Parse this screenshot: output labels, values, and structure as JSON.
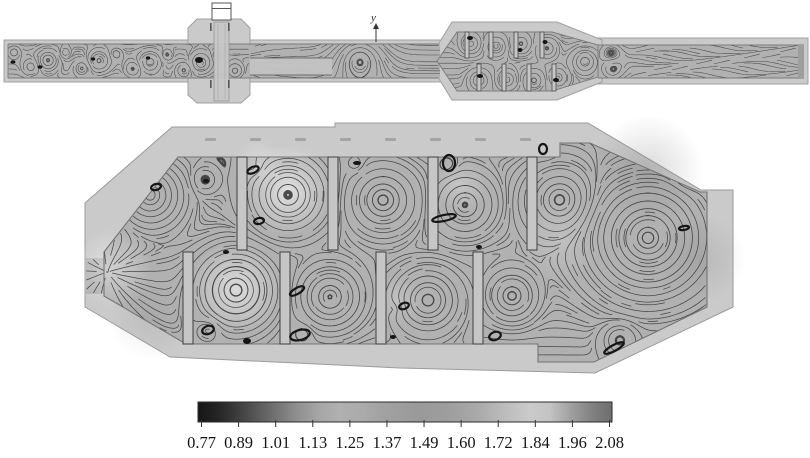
{
  "figure": {
    "axis_marker": {
      "label": "y"
    },
    "views": {
      "overview": {
        "name": "muffler-assembly-longitudinal-section"
      },
      "detail": {
        "name": "muffler-chamber-enlarged-section"
      }
    },
    "colorbar": {
      "orientation": "horizontal",
      "style": "grayscale",
      "tick_labels": [
        "0.77",
        "0.89",
        "1.01",
        "1.13",
        "1.25",
        "1.37",
        "1.49",
        "1.60",
        "1.72",
        "1.84",
        "1.96",
        "2.08"
      ],
      "gradient_stops": [
        [
          0,
          "#161616"
        ],
        [
          0.04,
          "#222222"
        ],
        [
          0.09,
          "#3a3a3a"
        ],
        [
          0.14,
          "#575757"
        ],
        [
          0.19,
          "#747474"
        ],
        [
          0.24,
          "#909090"
        ],
        [
          0.29,
          "#a5a5a5"
        ],
        [
          0.34,
          "#b0b0b0"
        ],
        [
          0.4,
          "#aaaaaa"
        ],
        [
          0.46,
          "#a0a0a0"
        ],
        [
          0.53,
          "#9a9a9a"
        ],
        [
          0.6,
          "#9d9d9d"
        ],
        [
          0.67,
          "#a8a8a8"
        ],
        [
          0.74,
          "#bcbcbc"
        ],
        [
          0.8,
          "#cacaca"
        ],
        [
          0.85,
          "#c4c4c4"
        ],
        [
          0.9,
          "#a0a0a0"
        ],
        [
          0.95,
          "#828282"
        ],
        [
          1,
          "#6e6e6e"
        ]
      ]
    },
    "colors": {
      "casing": "#cacaca",
      "interior_field": "#b1b1b1",
      "streamline": "#3a3a3a",
      "baffle_fill": "#c6c6c6",
      "page_background": "#ffffff",
      "colorbar_border": "#2b2b2b",
      "label_text": "#141414"
    }
  },
  "chart_data": {
    "type": "heatmap",
    "subtype": "streamline-contour-field",
    "title": "",
    "colorbar": {
      "min": 0.77,
      "max": 2.08,
      "tick_values": [
        0.77,
        0.89,
        1.01,
        1.13,
        1.25,
        1.37,
        1.49,
        1.6,
        1.72,
        1.84,
        1.96,
        2.08
      ],
      "colormap": "grayscale",
      "position": "bottom"
    },
    "axis_marker": "y",
    "views": [
      {
        "name": "full-assembly-section-view",
        "elements": [
          "inlet-duct",
          "cross-chamber-with-vertical-pipe",
          "connecting-duct",
          "baffled-expansion-body",
          "outlet-duct"
        ],
        "baffles_top": 4,
        "baffles_bottom": 4
      },
      {
        "name": "enlarged-chamber-section-view",
        "baffles_top": 4,
        "baffles_bottom": 4,
        "shape": "elongated-octagon"
      }
    ],
    "grid": false,
    "legend_position": "none"
  }
}
